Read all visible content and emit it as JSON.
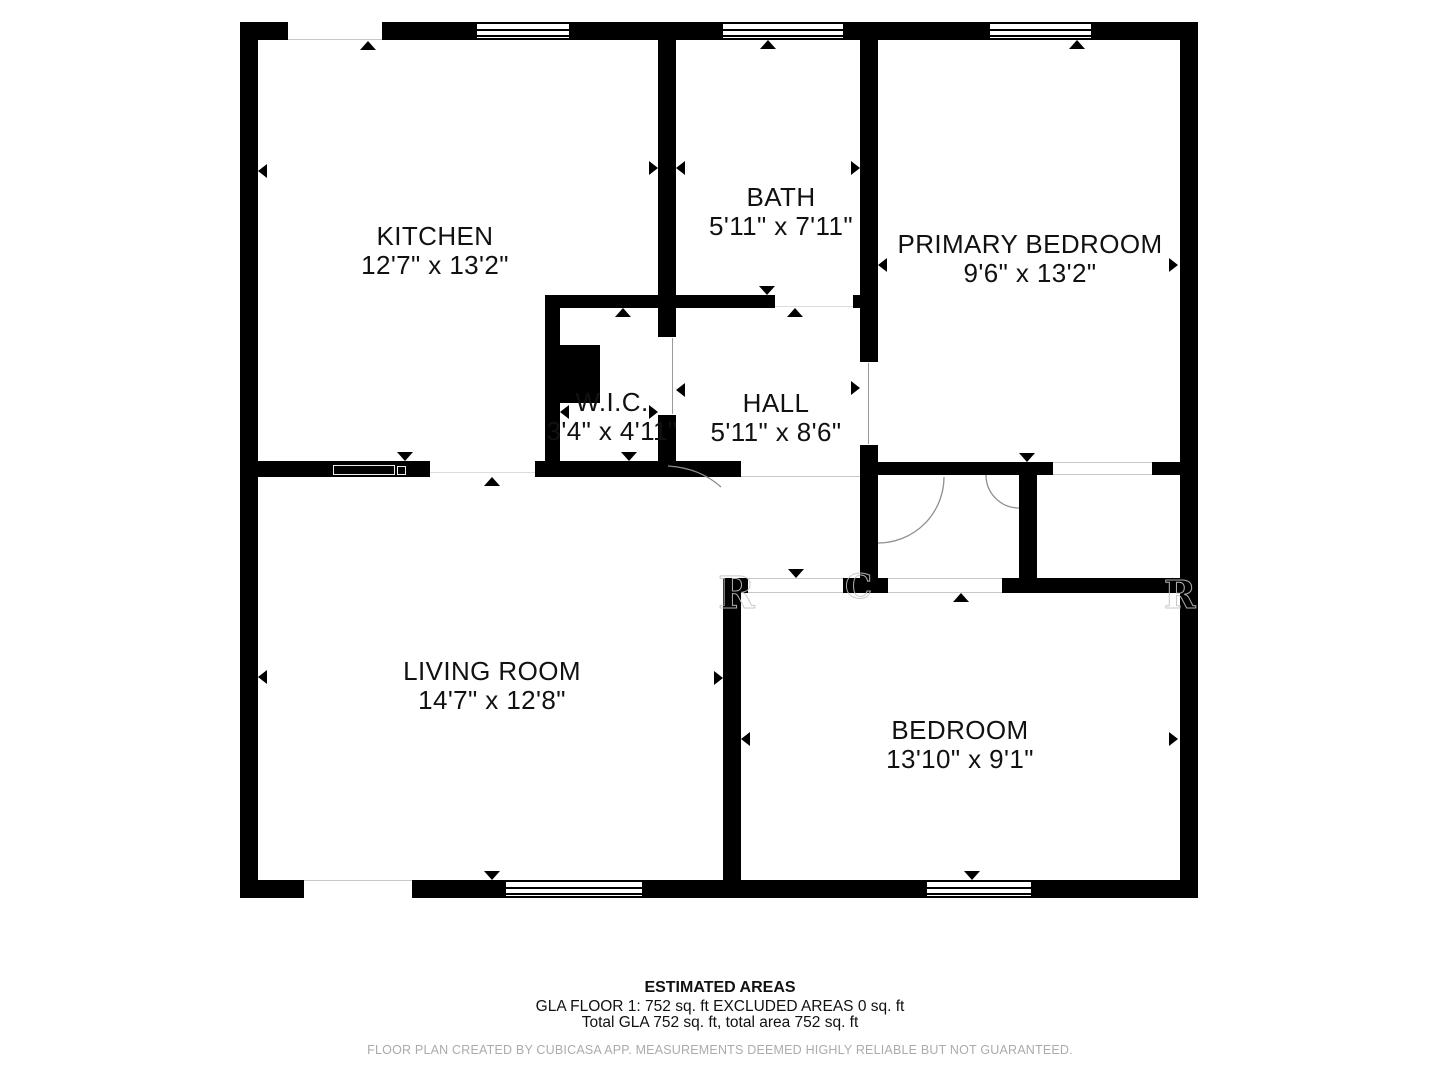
{
  "plan": {
    "rooms": [
      {
        "name": "KITCHEN",
        "dims": "12'7\" x 13'2\""
      },
      {
        "name": "BATH",
        "dims": "5'11\" x 7'11\""
      },
      {
        "name": "PRIMARY BEDROOM",
        "dims": "9'6\" x 13'2\""
      },
      {
        "name": "W.I.C.",
        "dims": "3'4\" x 4'11\""
      },
      {
        "name": "HALL",
        "dims": "5'11\" x 8'6\""
      },
      {
        "name": "LIVING ROOM",
        "dims": "14'7\" x 12'8\""
      },
      {
        "name": "BEDROOM",
        "dims": "13'10\" x 9'1\""
      }
    ],
    "watermark_fragments": [
      "R",
      "C",
      "R"
    ]
  },
  "footer": {
    "title": "ESTIMATED AREAS",
    "gla_line": "GLA FLOOR 1: 752 sq. ft EXCLUDED AREAS 0 sq. ft",
    "total_line": "Total GLA 752 sq. ft, total area 752 sq. ft",
    "disclaimer": "FLOOR PLAN CREATED BY CUBICASA APP. MEASUREMENTS DEEMED HIGHLY RELIABLE BUT NOT GUARANTEED."
  },
  "colors": {
    "wall": "#000000",
    "background": "#ffffff",
    "label_text": "#111111",
    "disclaimer_text": "#ababab"
  }
}
